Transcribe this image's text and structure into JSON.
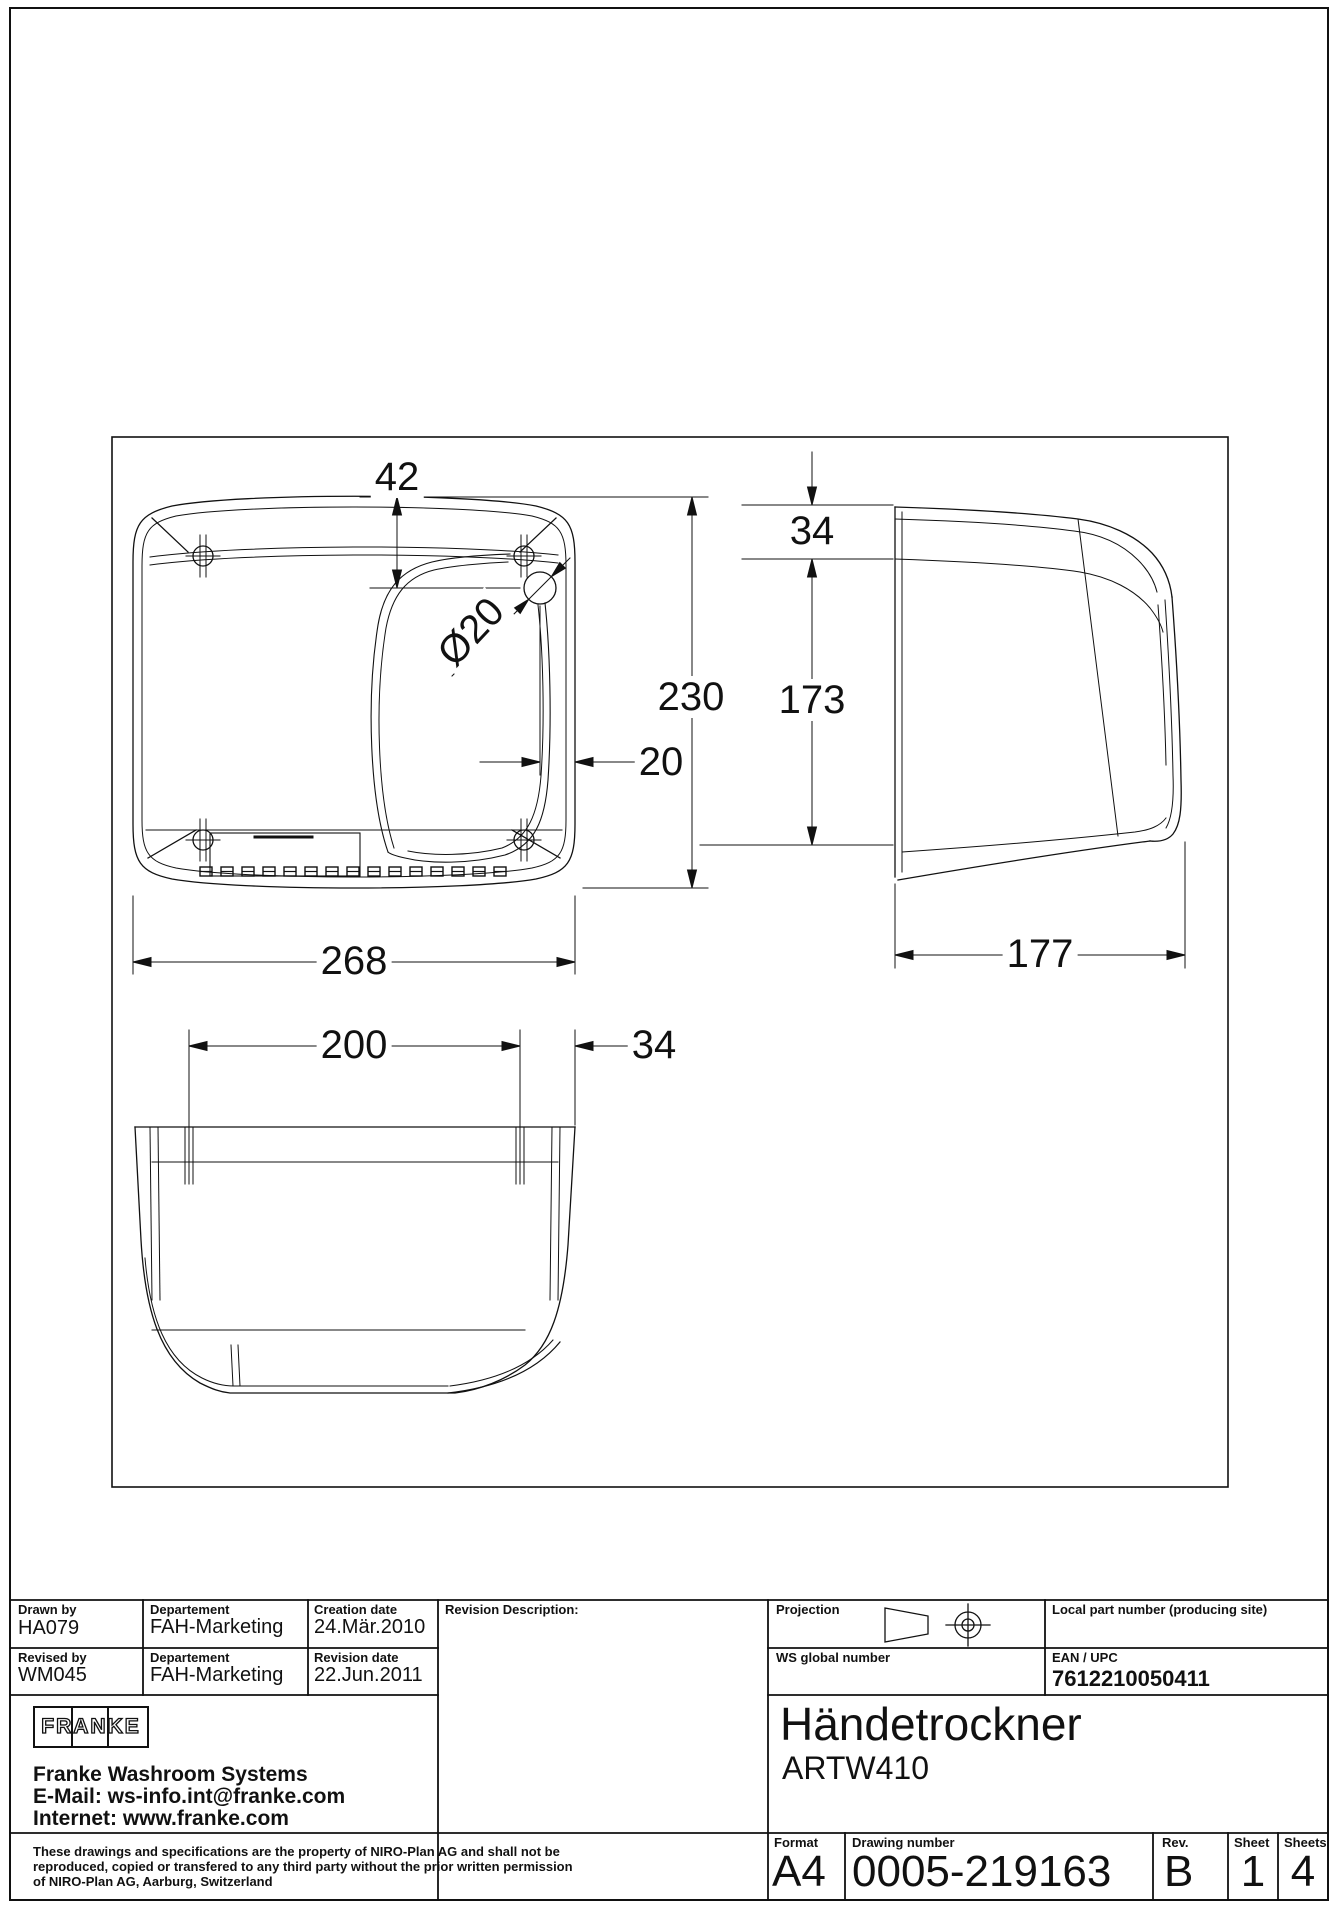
{
  "drawing": {
    "description": "three orthographic views of a wall-mounted hand dryer",
    "dimensions": {
      "front_top_hole_offset": "42",
      "front_hole_diameter": "Ø20",
      "front_height": "230",
      "front_hole_edge_offset": "20",
      "front_width": "268",
      "bottom_hole_spacing": "200",
      "bottom_hole_edge_offset": "34",
      "side_top_depth": "34",
      "side_front_height": "173",
      "side_depth": "177"
    }
  },
  "title_block": {
    "drawn_by": {
      "label": "Drawn by",
      "value": "HA079"
    },
    "drawn_departement": {
      "label": "Departement",
      "value": "FAH-Marketing"
    },
    "creation_date": {
      "label": "Creation date",
      "value": "24.Mär.2010"
    },
    "revised_by": {
      "label": "Revised by",
      "value": "WM045"
    },
    "revised_departement": {
      "label": "Departement",
      "value": "FAH-Marketing"
    },
    "revision_date": {
      "label": "Revision date",
      "value": "22.Jun.2011"
    },
    "revision_description_label": "Revision Description:",
    "projection_label": "Projection",
    "local_part_number_label": "Local part number (producing site)",
    "ws_global_number_label": "WS global number",
    "ean_upc": {
      "label": "EAN / UPC",
      "value": "7612210050411"
    },
    "product": {
      "title": "Händetrockner",
      "model": "ARTW410"
    },
    "format": {
      "label": "Format",
      "value": "A4"
    },
    "drawing_number": {
      "label": "Drawing number",
      "value": "0005-219163"
    },
    "revision": {
      "label": "Rev.",
      "value": "B"
    },
    "sheet": {
      "label": "Sheet",
      "value": "1"
    },
    "sheets": {
      "label": "Sheets",
      "value": "4"
    },
    "company": {
      "logo_text": "FRANKE",
      "name": "Franke Washroom Systems",
      "email": "E-Mail: ws-info.int@franke.com",
      "internet": "Internet: www.franke.com"
    },
    "legal_lines": [
      "These drawings and specifications are the property of NIRO-Plan AG and shall not be",
      "reproduced, copied or transfered to any third party without the prior written permission",
      "of NIRO-Plan AG, Aarburg, Switzerland"
    ]
  }
}
